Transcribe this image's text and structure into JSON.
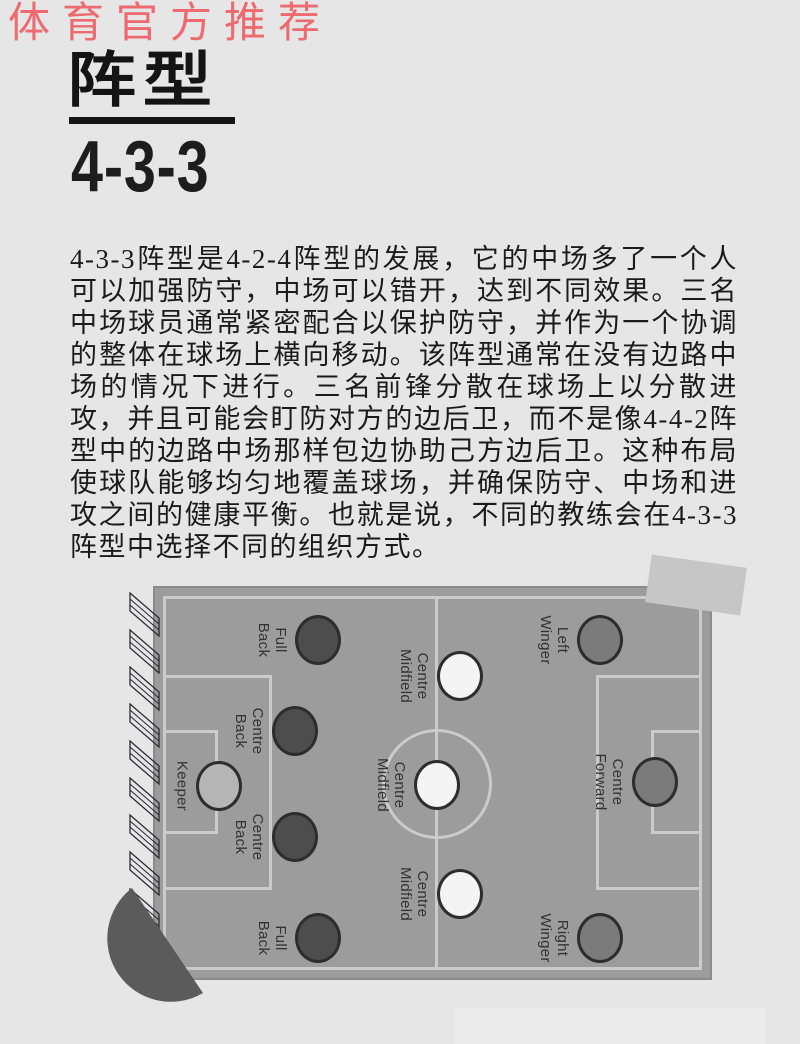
{
  "poster": {
    "watermark": "体育官方推荐",
    "title": "阵型",
    "formation": "4-3-3",
    "body": "4-3-3阵型是4-2-4阵型的发展，它的中场多了一个人可以加强防守，中场可以错开，达到不同效果。三名中场球员通常紧密配合以保护防守，并作为一个协调的整体在球场上横向移动。该阵型通常在没有边路中场的情况下进行。三名前锋分散在球场上以分散进攻，并且可能会盯防对方的边后卫，而不是像4-4-2阵型中的边路中场那样包边协助己方边后卫。这种布局使球队能够均匀地覆盖球场，并确保防守、中场和进攻之间的健康平衡。也就是说，不同的教练会在4-3-3 阵型中选择不同的组织方式。"
  },
  "pitch": {
    "formation_name": "4-3-3",
    "players": [
      {
        "role": "keeper",
        "label": "Keeper",
        "x": 64,
        "y": 198,
        "fill": "#b5b5b5"
      },
      {
        "role": "full-back-top",
        "label": "Full Back",
        "x": 163,
        "y": 52,
        "fill": "#4d4d4d"
      },
      {
        "role": "centre-back-top",
        "label": "Centre Back",
        "x": 140,
        "y": 143,
        "fill": "#4d4d4d"
      },
      {
        "role": "centre-back-bottom",
        "label": "Centre Back",
        "x": 140,
        "y": 249,
        "fill": "#4d4d4d"
      },
      {
        "role": "full-back-bottom",
        "label": "Full Back",
        "x": 163,
        "y": 350,
        "fill": "#4d4d4d"
      },
      {
        "role": "centre-midfield-top",
        "label": "Centre Midfield",
        "x": 305,
        "y": 88,
        "fill": "#f4f4f4"
      },
      {
        "role": "centre-midfield-middle",
        "label": "Centre Midfield",
        "x": 282,
        "y": 197,
        "fill": "#f4f4f4"
      },
      {
        "role": "centre-midfield-bottom",
        "label": "Centre Midfield",
        "x": 305,
        "y": 306,
        "fill": "#f4f4f4"
      },
      {
        "role": "left-winger",
        "label": "Left Winger",
        "x": 445,
        "y": 52,
        "fill": "#7b7b7b"
      },
      {
        "role": "centre-forward",
        "label": "Centre Forward",
        "x": 500,
        "y": 194,
        "fill": "#7b7b7b"
      },
      {
        "role": "right-winger",
        "label": "Right Winger",
        "x": 445,
        "y": 350,
        "fill": "#7b7b7b"
      }
    ]
  },
  "colors": {
    "background": "#e6e6e6",
    "watermark_red": "#ec6a70",
    "heading_black": "#141414",
    "pitch_fill": "#9c9c9c",
    "pitch_line": "#cbcbcb",
    "player_stroke": "#2d2d2d",
    "player_label": "#333333",
    "defender_fill": "#4d4d4d",
    "midfielder_fill": "#f4f4f4",
    "forward_fill": "#7b7b7b",
    "keeper_fill": "#b5b5b5",
    "fan_dark": "#5b5b5b",
    "tape_gray": "#c6c6c6"
  }
}
